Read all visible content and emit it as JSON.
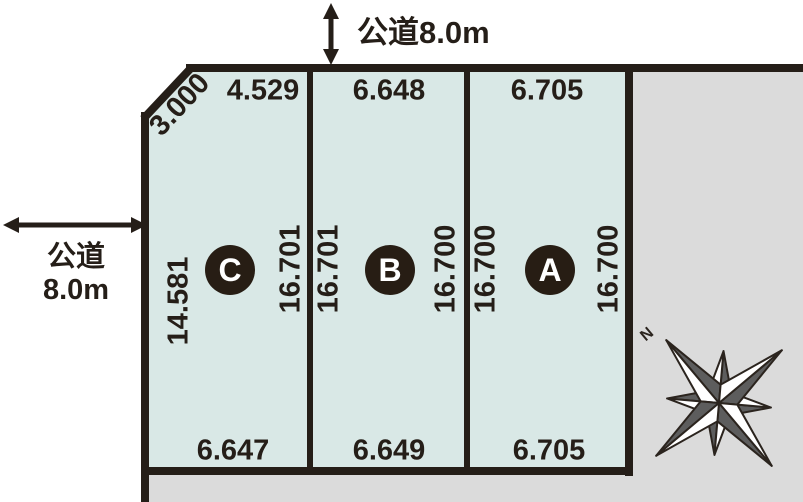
{
  "roads": {
    "top": {
      "label": "公道8.0m"
    },
    "left": {
      "line1": "公道",
      "line2": "8.0m"
    }
  },
  "plots": [
    {
      "id": "C",
      "top_dim": "4.529",
      "chamfer_dim": "3.000",
      "left_dim": "14.581",
      "right_dim": "16.701",
      "bottom_dim": "6.647"
    },
    {
      "id": "B",
      "top_dim": "6.648",
      "left_dim": "16.701",
      "right_dim": "16.700",
      "bottom_dim": "6.649"
    },
    {
      "id": "A",
      "top_dim": "6.705",
      "left_dim": "16.700",
      "right_dim": "16.700",
      "bottom_dim": "6.705"
    }
  ],
  "compass": {
    "north_label": "N"
  },
  "colors": {
    "line": "#251e18",
    "plot_fill": "#d9e8e6",
    "neighbor_gray": "#dbdbdb",
    "badge_fill": "#271d14"
  }
}
